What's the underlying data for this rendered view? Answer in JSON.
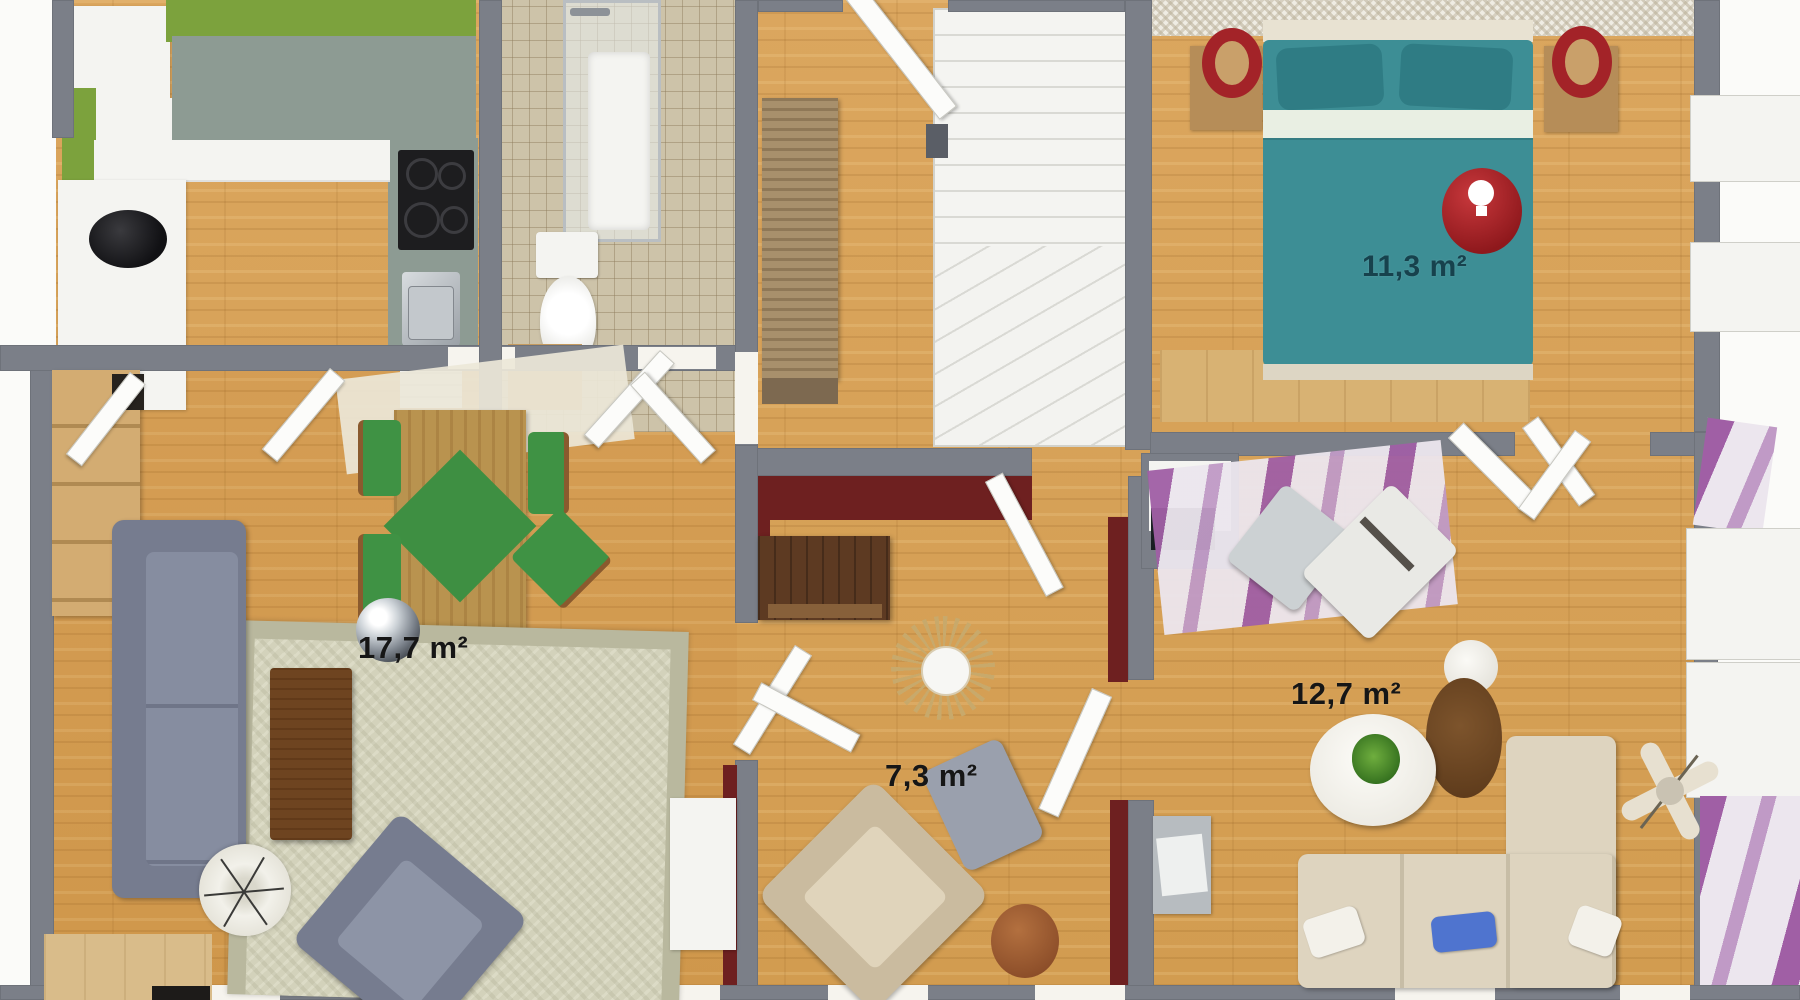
{
  "floor_plan": {
    "rooms": [
      {
        "id": "living-room",
        "area_label": "17,7 m²"
      },
      {
        "id": "hall-room",
        "area_label": "7,3 m²"
      },
      {
        "id": "bedroom",
        "area_label": "11,3 m²"
      },
      {
        "id": "sitting-room",
        "area_label": "12,7 m²"
      }
    ],
    "colors": {
      "wall": "#7b7f88",
      "kitchen_green": "#7ca23d",
      "countertop": "#8d9b93",
      "bath_tile": "#cdc3a9",
      "bed_teal": "#3d8e95",
      "accent_red": "#a32328",
      "maroon": "#6e2020",
      "stripe_purple": "#a05fa5",
      "sofa_gray": "#868da0",
      "sofa_cream": "#ded4bf",
      "rug_sage": "#ccccb4",
      "dining_green": "#3e8f42",
      "label_dark": "#161616",
      "label_teal": "#17424d"
    }
  }
}
